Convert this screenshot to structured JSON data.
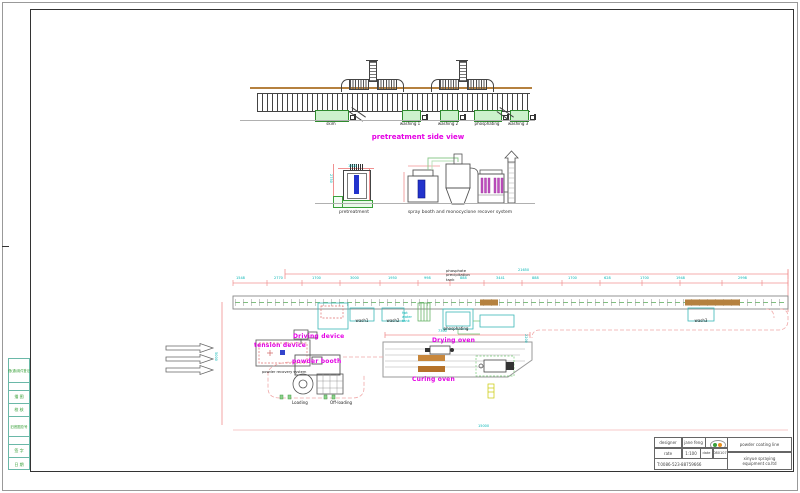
{
  "side_view": {
    "title": "pretreatment side view",
    "tank_labels": [
      "skim",
      "washing 1",
      "washing 2",
      "phosphating",
      "washing 3"
    ]
  },
  "elevation": {
    "pretreatment_label": "pretreatment",
    "spray_label": "spray booth and monocyclone recover system",
    "dim_v": "2750",
    "dim_h": "1500"
  },
  "plan": {
    "precip_l1": "phosphate",
    "precip_l2": "precipitation",
    "precip_l3": "tank",
    "hot_water_l1": "hot",
    "hot_water_l2": "water",
    "hot_water_l3": "tank",
    "tank_labels": [
      "wash1",
      "wash2",
      "phosphating",
      "wash3"
    ],
    "driving": "Driving device",
    "tension": "tension device",
    "powder_booth": "powder booth",
    "recovery": "powder recovery system",
    "loading": "Loading",
    "offloading": "Off-loading",
    "drying": "Drying oven",
    "curing": "Curing oven",
    "dim_total": "21650",
    "dim_oven": "7300",
    "dim_bottom": "15000",
    "dim_left_v": "5000",
    "dim_right_v": "2200",
    "chain_dims": [
      "1548",
      "2770",
      "1700",
      "3000",
      "1950",
      "998",
      "888",
      "3441",
      "888",
      "1700",
      "628",
      "1700",
      "1948",
      "2998"
    ]
  },
  "title_block": {
    "designer_label": "designer",
    "designer_name": "jane feng",
    "rate_label": "rate",
    "rate_value": "1:100",
    "date_label": "date",
    "date_value": "080107",
    "product": "powder coating line",
    "company_l1": "xinyue spraying",
    "company_l2": "equipment co.ltd",
    "phone": "T:0086-523-88759666"
  },
  "side_table": {
    "rows": [
      "借(通)用件登记",
      "",
      "描 图",
      "校 核",
      "旧底图总号",
      "",
      "签 字",
      "日 期"
    ]
  }
}
